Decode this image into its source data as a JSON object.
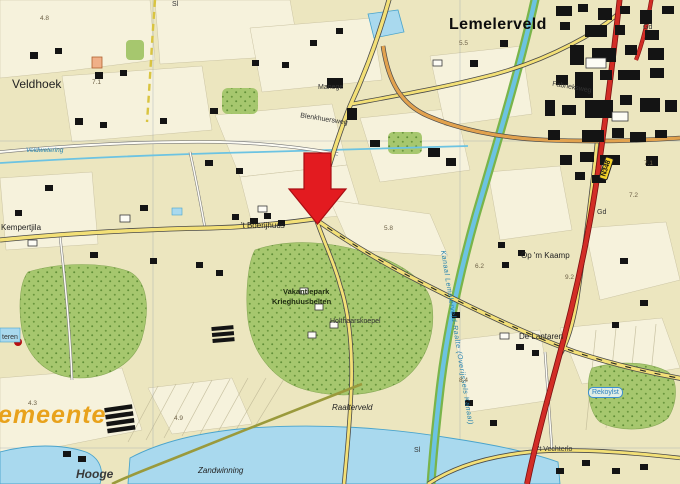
{
  "map": {
    "region_name": "Lemelerveld",
    "marker": {
      "shape": "down-arrow",
      "color": "#e31b20",
      "points_at": "road junction near 't Boerijhuus"
    },
    "colors": {
      "field": "#ece6bf",
      "parcel": "#f7f3de",
      "forest": "#a6c76e",
      "forest_dots": "#55852e",
      "water": "#a9d9ee",
      "canal": "#6cc3e2",
      "canal_bank": "#79b44a",
      "local_road": "#f3e077",
      "secondary_road": "#e2a24e",
      "main_road": "#d22d26",
      "building": "#141414",
      "arrow_red": "#e31b20",
      "gemeente_orange": "#e8a21c",
      "hydro_label_blue": "#1f7fae"
    },
    "labels": [
      {
        "id": "lemelerveld",
        "text": "Lemelerveld",
        "x": 449,
        "y": 17,
        "cls": "town-lg"
      },
      {
        "id": "veldhoek",
        "text": "Veldhoek",
        "x": 12,
        "y": 78,
        "cls": "place-md"
      },
      {
        "id": "manege",
        "text": "Manege",
        "x": 318,
        "y": 84,
        "cls": "tiny"
      },
      {
        "id": "street-blenkhuersweg",
        "text": "Blenkhuersweg",
        "x": 300,
        "y": 116,
        "cls": "tiny",
        "rot": 9
      },
      {
        "id": "boerijhuus",
        "text": "'t Boerijhuus",
        "x": 241,
        "y": 222,
        "cls": "small"
      },
      {
        "id": "kempertjila",
        "text": "Kempertjila",
        "x": 1,
        "y": 224,
        "cls": "small"
      },
      {
        "id": "vakantiepark-line1",
        "text": "Vakantiepark",
        "x": 283,
        "y": 288,
        "cls": "tiny-dark"
      },
      {
        "id": "vakantiepark-line2",
        "text": "Krieghuusbelten",
        "x": 272,
        "y": 298,
        "cls": "tiny-dark"
      },
      {
        "id": "holthaarskoepel",
        "text": "Holthaarskoepel",
        "x": 330,
        "y": 318,
        "cls": "tiny"
      },
      {
        "id": "op-m-kaamp",
        "text": "Op 'm Kaamp",
        "x": 521,
        "y": 252,
        "cls": "small"
      },
      {
        "id": "de-lantaren",
        "text": "De Lantaren",
        "x": 519,
        "y": 333,
        "cls": "small"
      },
      {
        "id": "raalterveld",
        "text": "Raalterveld",
        "x": 332,
        "y": 404,
        "cls": "small-italic"
      },
      {
        "id": "gemeente",
        "text": "emeente",
        "x": -2,
        "y": 403,
        "cls": "gemeente"
      },
      {
        "id": "hooge",
        "text": "Hooge",
        "x": 76,
        "y": 468,
        "cls": "place-italic"
      },
      {
        "id": "zandwinning",
        "text": "Zandwinning",
        "x": 198,
        "y": 467,
        "cls": "small-italic"
      },
      {
        "id": "vechterlo",
        "text": "'t Vechterlo",
        "x": 538,
        "y": 446,
        "cls": "tiny"
      },
      {
        "id": "rekoylst",
        "text": "Rekoylst",
        "x": 588,
        "y": 387,
        "cls": "blue-box"
      },
      {
        "id": "fabrieksweg",
        "text": "Fabrieksweg",
        "x": 552,
        "y": 84,
        "cls": "tiny",
        "rot": 10
      },
      {
        "id": "kanaal",
        "text": "Kanaal Lemelerveld-Raalte (Overijssels Kanaal)",
        "x": 446,
        "y": 250,
        "cls": "canal-label",
        "rot": 81
      },
      {
        "id": "veldwetering",
        "text": "Veldwetering",
        "x": 26,
        "y": 148,
        "cls": "blue-tiny"
      },
      {
        "id": "teren",
        "text": "teren",
        "x": 2,
        "y": 334,
        "cls": "tiny"
      },
      {
        "id": "sluis-1",
        "text": "Sl",
        "x": 414,
        "y": 447,
        "cls": "tiny"
      },
      {
        "id": "sluis-2",
        "text": "Sl",
        "x": 172,
        "y": 1,
        "cls": "tiny"
      },
      {
        "id": "gd-1",
        "text": "Gd",
        "x": 643,
        "y": 24,
        "cls": "tiny"
      },
      {
        "id": "gd-2",
        "text": "Gd",
        "x": 597,
        "y": 209,
        "cls": "tiny"
      },
      {
        "id": "n348-shield",
        "text": "N348",
        "x": 595,
        "y": 164,
        "cls": "shield",
        "rot": -72
      },
      {
        "id": "spot-4-8",
        "text": "4.8",
        "x": 40,
        "y": 16,
        "cls": "spot"
      },
      {
        "id": "spot-7-1a",
        "text": "7.1",
        "x": 92,
        "y": 80,
        "cls": "spot"
      },
      {
        "id": "spot-5-5",
        "text": "5.5",
        "x": 459,
        "y": 41,
        "cls": "spot"
      },
      {
        "id": "spot-5-8",
        "text": "5.8",
        "x": 384,
        "y": 226,
        "cls": "spot"
      },
      {
        "id": "spot-6-2",
        "text": "6.2",
        "x": 475,
        "y": 264,
        "cls": "spot"
      },
      {
        "id": "spot-9-2",
        "text": "9.2",
        "x": 565,
        "y": 275,
        "cls": "spot"
      },
      {
        "id": "spot-8-4",
        "text": "8.4",
        "x": 459,
        "y": 378,
        "cls": "spot"
      },
      {
        "id": "spot-4-3",
        "text": "4.3",
        "x": 28,
        "y": 401,
        "cls": "spot"
      },
      {
        "id": "spot-4-9",
        "text": "4.9",
        "x": 174,
        "y": 416,
        "cls": "spot"
      },
      {
        "id": "spot-7-2",
        "text": "7.2",
        "x": 629,
        "y": 193,
        "cls": "spot"
      },
      {
        "id": "spot-7-1b",
        "text": "7.1",
        "x": 644,
        "y": 161,
        "cls": "spot"
      }
    ]
  }
}
